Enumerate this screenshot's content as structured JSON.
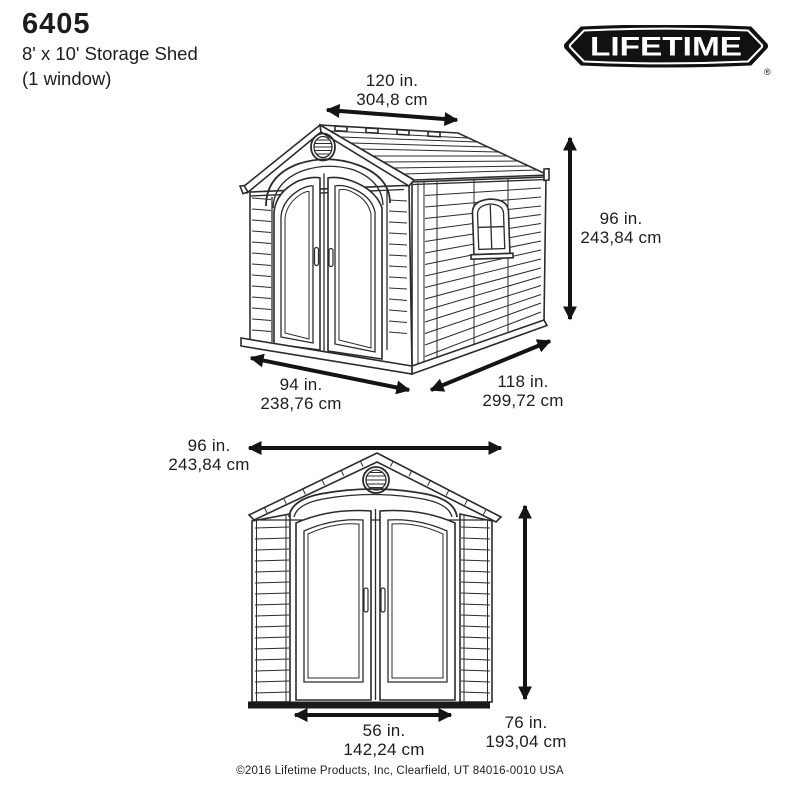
{
  "header": {
    "model": "6405",
    "line1": "8' x 10' Storage Shed",
    "line2": "(1 window)"
  },
  "logo": {
    "text": "LIFETIME",
    "registered": "®"
  },
  "perspective": {
    "roof_length_in": "120 in.",
    "roof_length_cm": "304,8 cm",
    "height_in": "96 in.",
    "height_cm": "243,84 cm",
    "front_width_in": "94 in.",
    "front_width_cm": "238,76 cm",
    "depth_in": "118 in.",
    "depth_cm": "299,72 cm"
  },
  "front_view": {
    "width_in": "96 in.",
    "width_cm": "243,84 cm",
    "door_height_in": "76 in.",
    "door_height_cm": "193,04 cm",
    "door_width_in": "56 in.",
    "door_width_cm": "142,24 cm"
  },
  "footer": {
    "copyright": "©2016 Lifetime Products, Inc, Clearfield, UT 84016-0010 USA"
  },
  "colors": {
    "line": "#2b2b2b",
    "text": "#1d1d1b",
    "logo_background": "#111111"
  }
}
